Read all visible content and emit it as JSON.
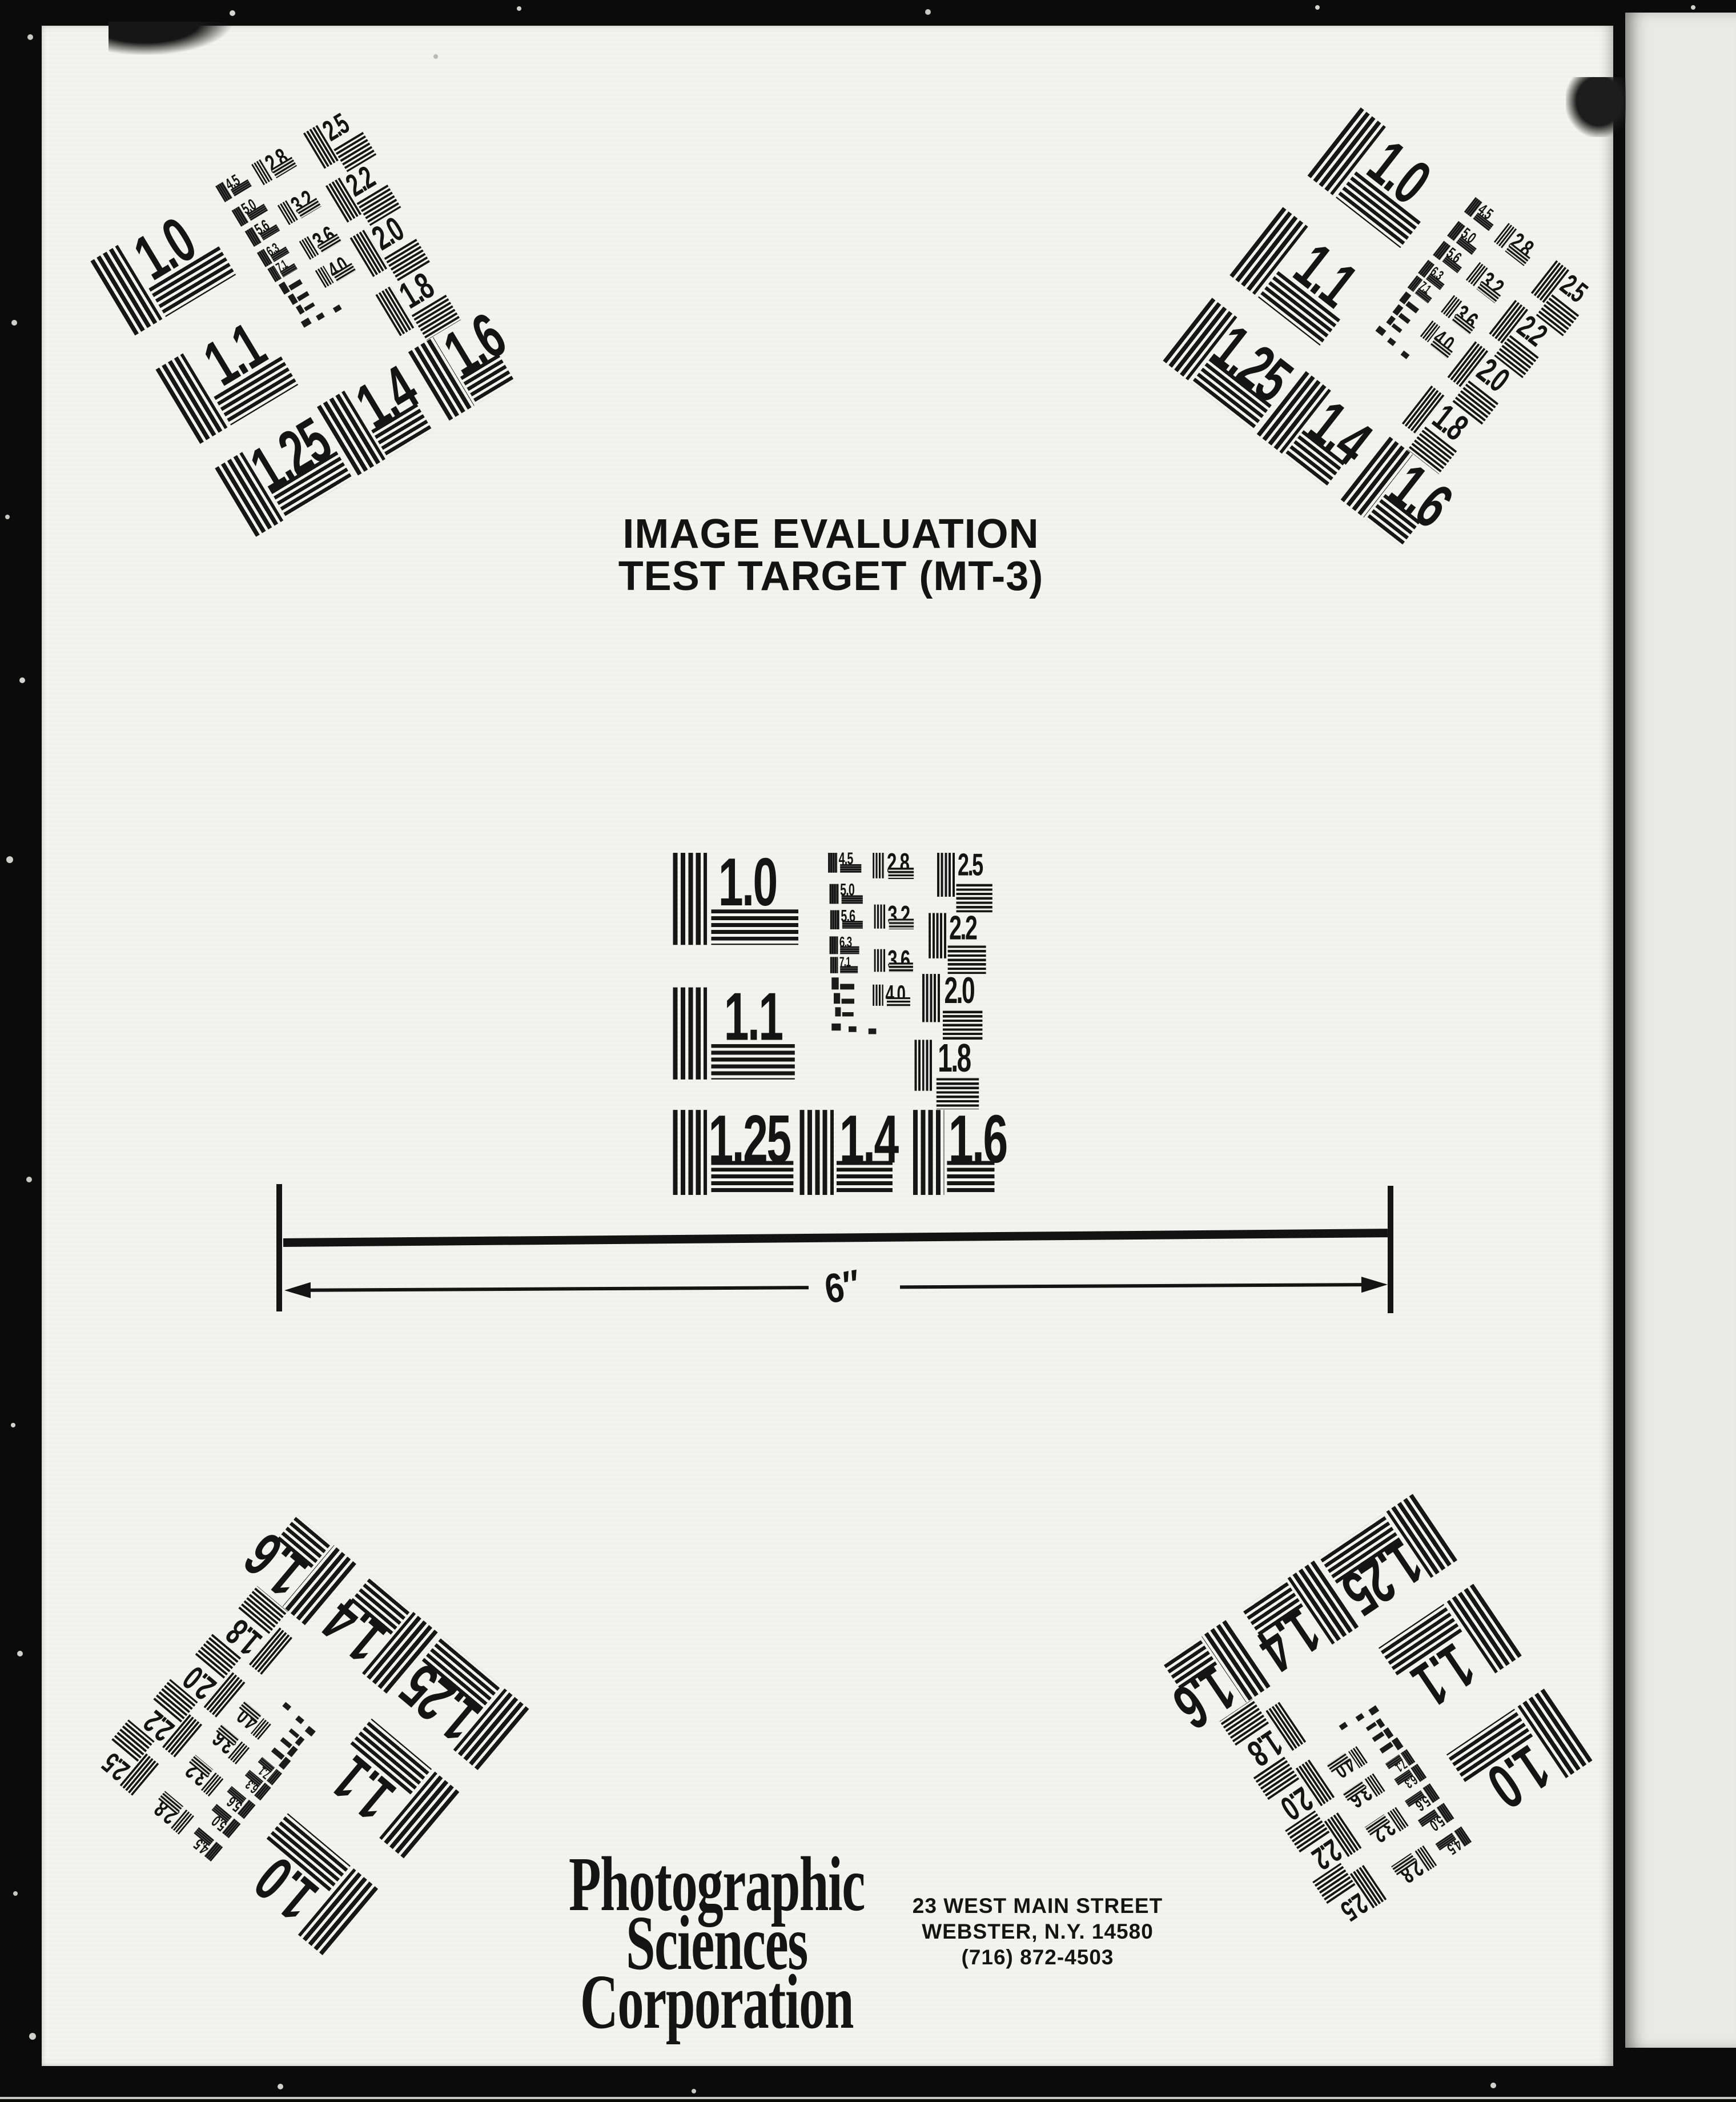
{
  "title": {
    "line1": "IMAGE EVALUATION",
    "line2": "TEST TARGET (MT-3)"
  },
  "ruler": {
    "label": "6″"
  },
  "organization": {
    "name_lines": [
      "Photographic",
      "Sciences",
      "Corporation"
    ],
    "address_lines": [
      "23 WEST MAIN STREET",
      "WEBSTER, N.Y. 14580",
      "(716) 872-4503"
    ]
  },
  "target_labels": {
    "big": [
      "1.0",
      "1.1",
      "1.25",
      "1.4",
      "1.6"
    ],
    "right_column": [
      "2.5",
      "2.2",
      "2.0",
      "1.8"
    ],
    "small_column_a": [
      "4.5",
      "5.0",
      "5.6",
      "6.3",
      "7.1"
    ],
    "small_column_b": [
      "2.8",
      "3.2",
      "3.6",
      "4.0"
    ]
  },
  "colors": {
    "film_background": "#0b0b0b",
    "paper": "#f3f3f1",
    "paper_edge_strip": "#e9e9e7",
    "ink": "#141414"
  }
}
